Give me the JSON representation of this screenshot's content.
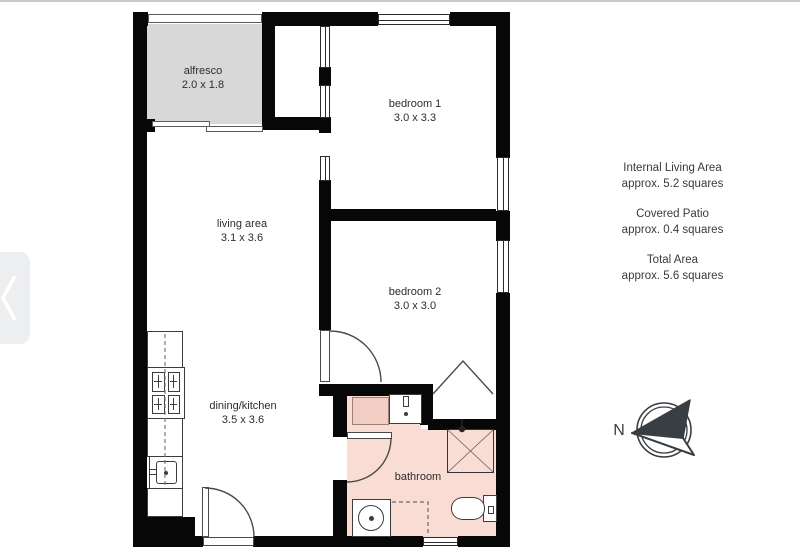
{
  "page": {
    "top_border_color": "#c9c9c9",
    "background": "#ffffff"
  },
  "nav": {
    "prev_button": "previous",
    "chevron_color": "#ffffff"
  },
  "floorplan": {
    "rooms": [
      {
        "id": "alfresco",
        "name": "alfresco",
        "dims": "2.0 x 1.8"
      },
      {
        "id": "bedroom1",
        "name": "bedroom 1",
        "dims": "3.0 x 3.3"
      },
      {
        "id": "living",
        "name": "living area",
        "dims": "3.1 x 3.6"
      },
      {
        "id": "bedroom2",
        "name": "bedroom 2",
        "dims": "3.0 x 3.0"
      },
      {
        "id": "dining",
        "name": "dining/kitchen",
        "dims": "3.5 x 3.6"
      },
      {
        "id": "bathroom",
        "name": "bathroom",
        "dims": ""
      }
    ],
    "fixtures": [
      "kitchen bench",
      "stove",
      "kitchen sink",
      "entry door",
      "sliding door",
      "wardrobe",
      "bathroom cabinet",
      "vanity sink",
      "shower",
      "toilet",
      "washing machine"
    ],
    "colors": {
      "wall": "#070707",
      "alfresco_fill": "#d8d8d8",
      "bathroom_fill": "#f9ddd5",
      "cabinet_fill": "#f2cdc3",
      "linework": "#4a4a4a"
    }
  },
  "summary": {
    "items": [
      {
        "title": "Internal Living Area",
        "value": "approx. 5.2 squares"
      },
      {
        "title": "Covered Patio",
        "value": "approx. 0.4 squares"
      },
      {
        "title": "Total Area",
        "value": "approx. 5.6 squares"
      }
    ]
  },
  "compass": {
    "label": "N"
  }
}
